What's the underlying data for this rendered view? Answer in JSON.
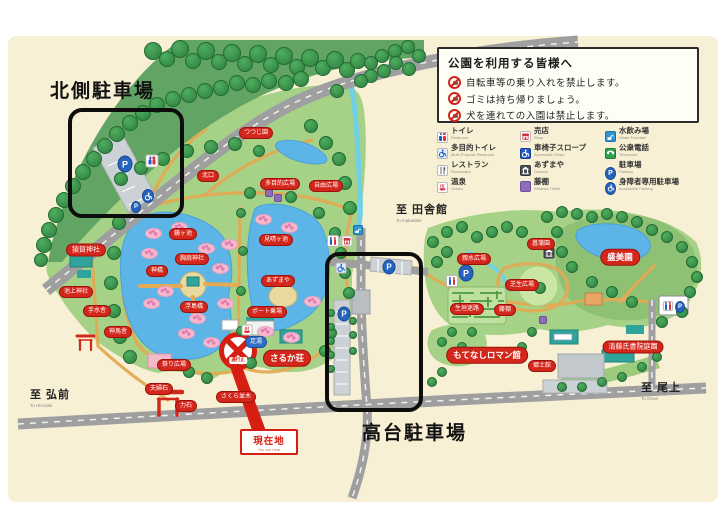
{
  "notice_panel": {
    "title": "公園を利用する皆様へ",
    "rules": [
      {
        "icon": "no-bicycle-icon",
        "text": "自転車等の乗り入れを禁止します。"
      },
      {
        "icon": "no-litter-icon",
        "text": "ゴミは持ち帰りましょう。"
      },
      {
        "icon": "no-dog-icon",
        "text": "犬を連れての入園は禁止します。"
      }
    ]
  },
  "legend": {
    "items": [
      {
        "jp": "トイレ",
        "en": "Restroom",
        "icon": "toilet-icon"
      },
      {
        "jp": "多目的トイレ",
        "en": "Multi-Purpose Restroom",
        "icon": "accessible-toilet-icon"
      },
      {
        "jp": "レストラン",
        "en": "Restaurant",
        "icon": "restaurant-icon"
      },
      {
        "jp": "温泉",
        "en": "Onsen",
        "icon": "onsen-icon"
      },
      {
        "jp": "売店",
        "en": "Shop",
        "icon": "shop-icon"
      },
      {
        "jp": "車椅子スロープ",
        "en": "Accessible Slope",
        "icon": "accessible-slope-icon"
      },
      {
        "jp": "あずまや",
        "en": "Gazebo",
        "icon": "gazebo-icon"
      },
      {
        "jp": "藤棚",
        "en": "Wisteria Trellis",
        "icon": "wisteria-icon"
      },
      {
        "jp": "水飲み場",
        "en": "Water Fountain",
        "icon": "water-icon"
      },
      {
        "jp": "公衆電話",
        "en": "Telephone",
        "icon": "phone-icon"
      },
      {
        "jp": "駐車場",
        "en": "Parking",
        "icon": "parking-icon"
      },
      {
        "jp": "身障者専用駐車場",
        "en": "Accessible Parking",
        "icon": "accessible-parking-icon"
      }
    ]
  },
  "parking_labels": {
    "north": "北側駐車場",
    "hilltop": "高台駐車場"
  },
  "directions": [
    {
      "jp": "至 弘前",
      "en": "To Hirosaki"
    },
    {
      "jp": "至 田舎館",
      "en": "To Inakadate"
    },
    {
      "jp": "至 尾上",
      "en": "To Onoe"
    }
  ],
  "current_location": {
    "jp": "現在地",
    "en": "You are here"
  },
  "road_closed": "通行止",
  "map_labels": [
    {
      "t": "猿賀神社",
      "x": 86,
      "y": 250,
      "s": "md"
    },
    {
      "t": "池上神社",
      "x": 76,
      "y": 292
    },
    {
      "t": "手水舎",
      "x": 97,
      "y": 311
    },
    {
      "t": "神馬舎",
      "x": 118,
      "y": 332
    },
    {
      "t": "北口",
      "x": 208,
      "y": 176
    },
    {
      "t": "鏡ヶ池",
      "x": 183,
      "y": 234
    },
    {
      "t": "胸肩神社",
      "x": 192,
      "y": 259
    },
    {
      "t": "神橋",
      "x": 157,
      "y": 271
    },
    {
      "t": "浮島橋",
      "x": 194,
      "y": 307
    },
    {
      "t": "見晴ヶ池",
      "x": 276,
      "y": 240
    },
    {
      "t": "あずまや",
      "x": 278,
      "y": 281
    },
    {
      "t": "ボート乗場",
      "x": 267,
      "y": 312
    },
    {
      "t": "つつじ園",
      "x": 256,
      "y": 133
    },
    {
      "t": "多目的広場",
      "x": 280,
      "y": 184
    },
    {
      "t": "自由広場",
      "x": 326,
      "y": 186
    },
    {
      "t": "祭り広場",
      "x": 174,
      "y": 365
    },
    {
      "t": "夫婦石",
      "x": 159,
      "y": 389
    },
    {
      "t": "力石",
      "x": 186,
      "y": 406
    },
    {
      "t": "さくら並木",
      "x": 236,
      "y": 397
    },
    {
      "t": "さるか荘",
      "x": 287,
      "y": 358,
      "s": "big"
    },
    {
      "t": "足湯",
      "x": 256,
      "y": 342,
      "c": "blue"
    },
    {
      "t": "親水広場",
      "x": 474,
      "y": 259
    },
    {
      "t": "菖蒲園",
      "x": 541,
      "y": 244
    },
    {
      "t": "芝生広場",
      "x": 522,
      "y": 285
    },
    {
      "t": "生垣迷路",
      "x": 467,
      "y": 309
    },
    {
      "t": "藤棚",
      "x": 505,
      "y": 310
    },
    {
      "t": "もてなしロマン館",
      "x": 487,
      "y": 355,
      "s": "big"
    },
    {
      "t": "郷土館",
      "x": 542,
      "y": 366
    },
    {
      "t": "盛美園",
      "x": 620,
      "y": 257,
      "s": "big"
    },
    {
      "t": "清藤氏書院庭園",
      "x": 633,
      "y": 347,
      "s": "md"
    }
  ],
  "map_icons": [
    {
      "type": "parking-icon",
      "x": 125,
      "y": 163,
      "s": 15
    },
    {
      "type": "toilet-icon",
      "x": 152,
      "y": 161,
      "s": 13
    },
    {
      "type": "accessible-parking-icon",
      "x": 148,
      "y": 195,
      "s": 12
    },
    {
      "type": "parking-icon",
      "x": 136,
      "y": 206,
      "s": 10
    },
    {
      "type": "toilet-icon",
      "x": 333,
      "y": 241,
      "s": 12
    },
    {
      "type": "shop-icon",
      "x": 347,
      "y": 241,
      "s": 11
    },
    {
      "type": "water-icon",
      "x": 358,
      "y": 230,
      "s": 10
    },
    {
      "type": "accessible-toilet-icon",
      "x": 341,
      "y": 268,
      "s": 11
    },
    {
      "type": "parking-icon",
      "x": 389,
      "y": 266,
      "s": 13
    },
    {
      "type": "parking-icon",
      "x": 344,
      "y": 313,
      "s": 13
    },
    {
      "type": "parking-icon",
      "x": 466,
      "y": 272,
      "s": 15
    },
    {
      "type": "toilet-icon",
      "x": 452,
      "y": 281,
      "s": 12
    },
    {
      "type": "gazebo-icon",
      "x": 549,
      "y": 253,
      "s": 11
    },
    {
      "type": "onsen-icon",
      "x": 247,
      "y": 330,
      "s": 11
    },
    {
      "type": "wisteria-icon",
      "x": 269,
      "y": 193,
      "s": 8
    },
    {
      "type": "wisteria-icon",
      "x": 278,
      "y": 198,
      "s": 8
    },
    {
      "type": "wisteria-icon",
      "x": 543,
      "y": 320,
      "s": 8
    },
    {
      "type": "toilet-icon",
      "x": 668,
      "y": 306,
      "s": 10
    },
    {
      "type": "parking-icon",
      "x": 680,
      "y": 306,
      "s": 10
    }
  ],
  "colors": {
    "label_red": "#d4271c",
    "park_green": "#a6d287",
    "pond_blue": "#5cb5e6",
    "road_gray": "#9f9f9f",
    "highlight_black": "#0d0d0d",
    "parking_blue": "#2663bd",
    "map_beige": "#f8f0d4"
  }
}
